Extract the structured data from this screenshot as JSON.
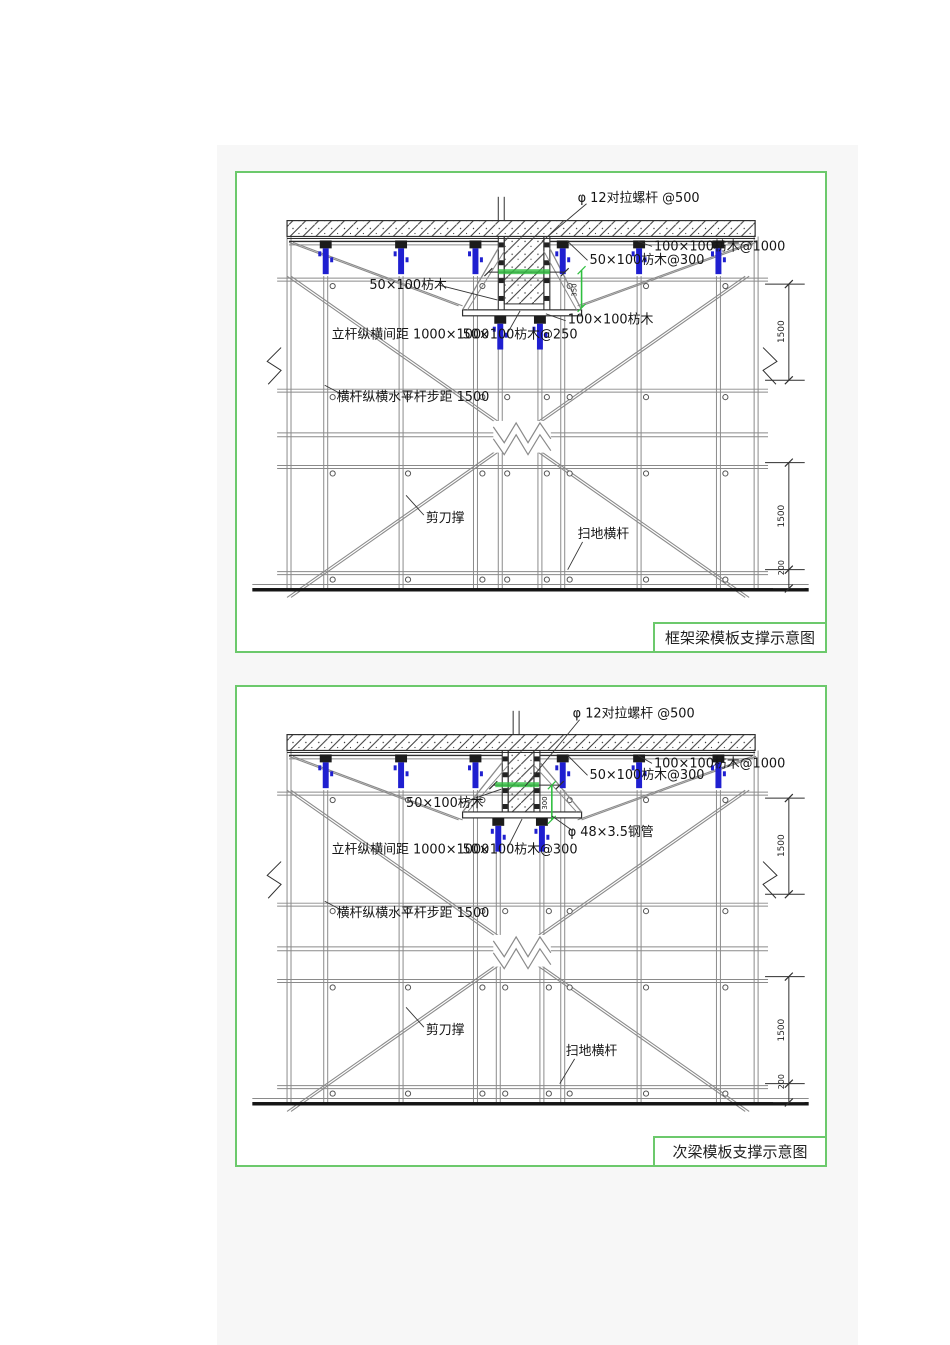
{
  "colors": {
    "panel_border": "#6cc96c",
    "prop_blue": "#1f1fd0",
    "highlight_green": "#2fbf3f",
    "line_dark": "#2f2f2f",
    "line_gray": "#8a8a8a",
    "column_bg": "#f7f7f7"
  },
  "panel1": {
    "title": "框架梁模板支撑示意图",
    "labels": {
      "tie_rod": "φ 12对拉螺杆 @500",
      "timber_100x100_at_1000": "100×100枋木@1000",
      "timber_50x100_at_300": "50×100枋木@300",
      "timber_50x100": "50×100枋木",
      "timber_100x100": "100×100枋木",
      "post_spacing": "立杆纵横间距 1000×1000",
      "timber_50x100_at_250": "50×100枋木@250",
      "ledger_spacing": "横杆纵横水平杆步距 1500",
      "scissor_brace": "剪刀撑",
      "sweep_rod": "扫地横杆"
    },
    "dims": {
      "upper": "1500",
      "lower": "1500",
      "bottom": "200",
      "beam": "350"
    }
  },
  "panel2": {
    "title": "次梁模板支撑示意图",
    "labels": {
      "tie_rod": "φ 12对拉螺杆 @500",
      "timber_100x100_at_1000": "100×100枋木@1000",
      "timber_50x100_at_300": "50×100枋木@300",
      "timber_50x100": "50×100枋木",
      "steel_pipe": "φ 48×3.5钢管",
      "post_spacing": "立杆纵横间距 1000×1000",
      "timber_50x100_at_300_bottom": "50×100枋木@300",
      "ledger_spacing": "横杆纵横水平杆步距 1500",
      "scissor_brace": "剪刀撑",
      "sweep_rod": "扫地横杆"
    },
    "dims": {
      "upper": "1500",
      "lower": "1500",
      "bottom": "200",
      "beam": "300"
    }
  }
}
